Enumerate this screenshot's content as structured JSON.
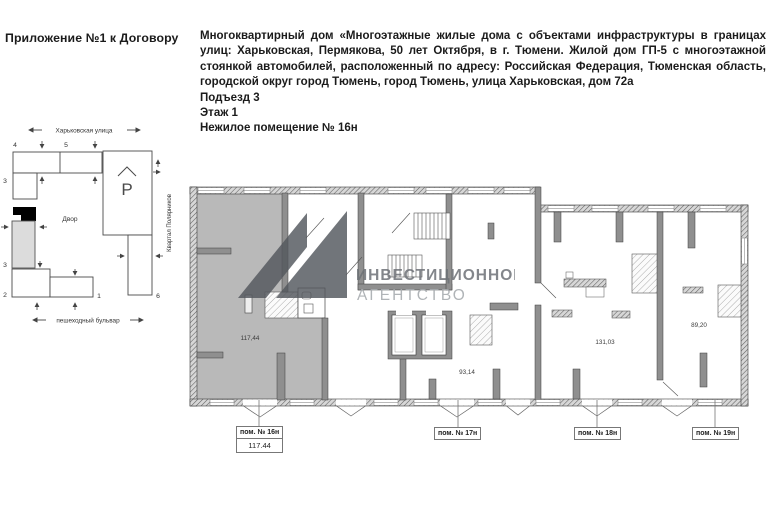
{
  "document": {
    "appendix_title": "Приложение №1 к Договору",
    "description": "Многоквартирный дом «Многоэтажные жилые дома с объектами инфраструктуры в границах улиц: Харьковская, Пермякова, 50 лет Октября, в г. Тюмени. Жилой дом ГП-5 с многоэтажной стоянкой автомобилей, расположенный по адресу: Российская Федерация, Тюменская область, городской округ город Тюмень, город Тюмень, улица Харьковская, дом 72а",
    "entrance": "Подъезд 3",
    "floor": "Этаж 1",
    "premise": "Нежилое помещение № 16н"
  },
  "site_plan": {
    "street_top": "Харьковская улица",
    "boulevard_bottom": "пешеходный бульвар",
    "quarter_right": "Квартал Полярников",
    "courtyard": "Двор",
    "parking_label": "P",
    "numbers": {
      "n1": "1",
      "n2": "2",
      "n3a": "3",
      "n3b": "3",
      "n4": "4",
      "n5": "5",
      "n6": "6"
    }
  },
  "floor_plan": {
    "areas": {
      "a16": "117,44",
      "a17": "93,14",
      "a18": "131,03",
      "a19": "89,20"
    },
    "units": [
      {
        "label": "пом. № 16н",
        "area": "117.44"
      },
      {
        "label": "пом. № 17н"
      },
      {
        "label": "пом. № 18н"
      },
      {
        "label": "пом. № 19н"
      }
    ]
  },
  "watermark": {
    "line1": "ИНВЕСТИЦИОННОЕ",
    "line2": "АГЕНТСТВО"
  }
}
